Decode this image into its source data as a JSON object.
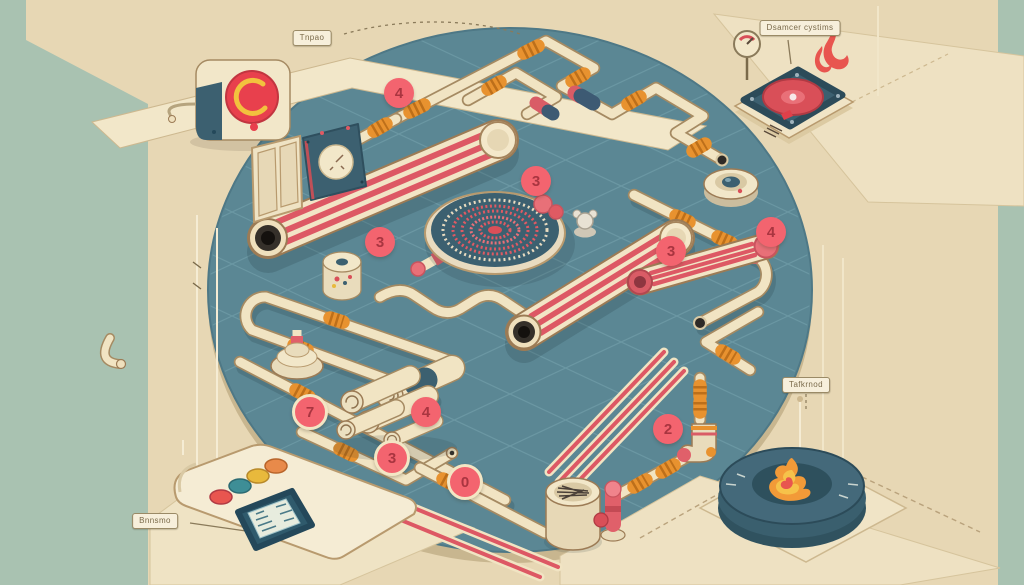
{
  "labels": {
    "top_left": {
      "text": "Tnpao"
    },
    "top_right": {
      "text": "Dsamcer cystims"
    },
    "right_side": {
      "text": "Tafkrnod"
    },
    "bottom_left": {
      "text": "Bnnsmo"
    }
  },
  "badges": [
    {
      "value": "4"
    },
    {
      "value": "3"
    },
    {
      "value": "3"
    },
    {
      "value": "3"
    },
    {
      "value": "4"
    },
    {
      "value": "7"
    },
    {
      "value": "4"
    },
    {
      "value": "3"
    },
    {
      "value": "0"
    },
    {
      "value": "2"
    }
  ],
  "icons": {
    "top_right_device": "flame-icon",
    "bottom_right_device": "flame-icon",
    "top_right_meter": "pressure-gauge-icon"
  },
  "palette": {
    "background_tan": "#e7d7b4",
    "side_band_sage": "#a9c2b1",
    "platform_teal": "#5b8794",
    "plane_cream": "#f2e7c9",
    "pipe_cream": "#f1e4c3",
    "stripe_red": "#dd5864",
    "coupling_orange": "#e8922f",
    "fitting_blue": "#3d5a73",
    "badge_pink": "#f3646f",
    "device_blue": "#3c6070",
    "flame_orange": "#f29a38",
    "alarm_red": "#e8404d"
  }
}
